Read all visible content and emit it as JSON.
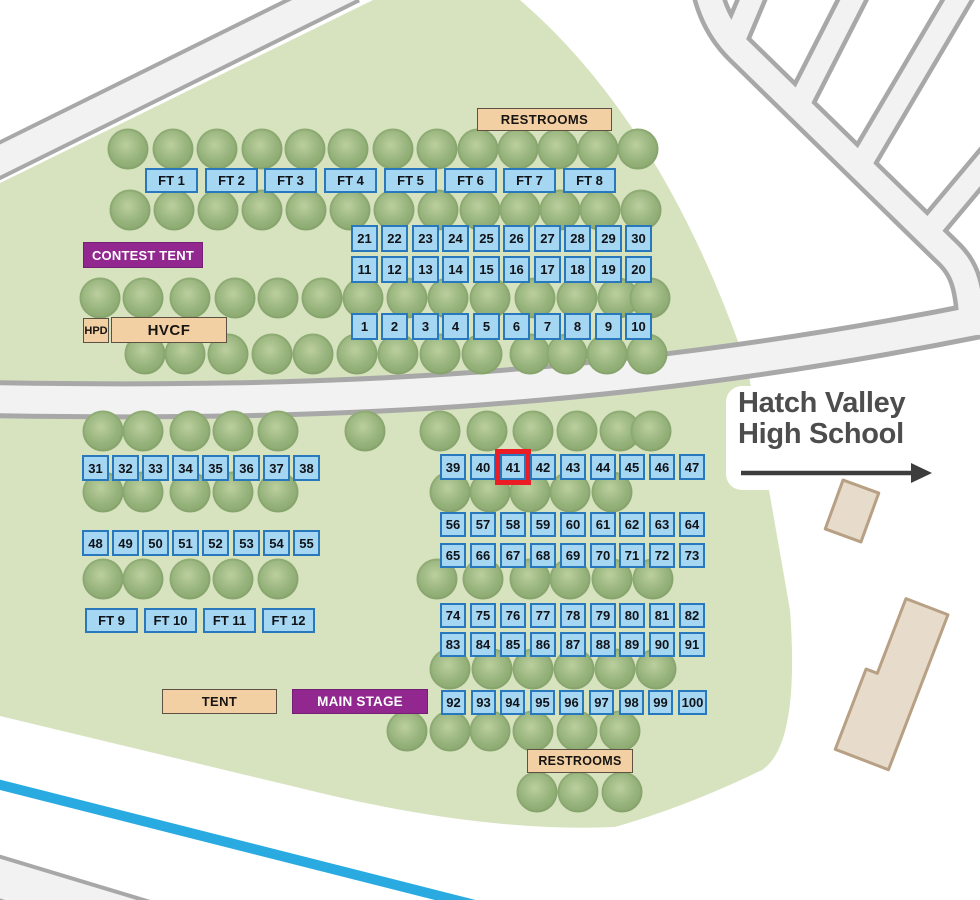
{
  "map": {
    "title_area": {
      "school": {
        "line1": "Hatch Valley",
        "line2": "High School"
      }
    },
    "labels": {
      "restrooms_top": {
        "text": "RESTROOMS"
      },
      "contest_tent": {
        "text": "CONTEST TENT"
      },
      "hpd": {
        "text": "HPD"
      },
      "hvcf": {
        "text": "HVCF"
      },
      "tent": {
        "text": "TENT"
      },
      "main_stage": {
        "text": "MAIN STAGE"
      },
      "restrooms_bottom": {
        "text": "RESTROOMS"
      }
    },
    "highlighted_booth": "41",
    "booth_rows": [
      {
        "labels": [
          "21",
          "22",
          "23",
          "24",
          "25",
          "26",
          "27",
          "28",
          "29",
          "30"
        ],
        "x": 351,
        "y": 225,
        "gap": 30.44,
        "w": 27,
        "h": 27
      },
      {
        "labels": [
          "11",
          "12",
          "13",
          "14",
          "15",
          "16",
          "17",
          "18",
          "19",
          "20"
        ],
        "x": 351,
        "y": 256,
        "gap": 30.44,
        "w": 27,
        "h": 27
      },
      {
        "labels": [
          "1",
          "2",
          "3",
          "4",
          "5",
          "6",
          "7",
          "8",
          "9",
          "10"
        ],
        "x": 351,
        "y": 313,
        "gap": 30.44,
        "w": 27,
        "h": 27
      },
      {
        "labels": [
          "31",
          "32",
          "33",
          "34",
          "35",
          "36",
          "37",
          "38"
        ],
        "x": 82,
        "y": 455,
        "gap": 30.1,
        "w": 27,
        "h": 26
      },
      {
        "labels": [
          "39",
          "40",
          "41",
          "42",
          "43",
          "44",
          "45",
          "46",
          "47"
        ],
        "x": 440,
        "y": 454,
        "gap": 29.9,
        "w": 26,
        "h": 26
      },
      {
        "labels": [
          "48",
          "49",
          "50",
          "51",
          "52",
          "53",
          "54",
          "55"
        ],
        "x": 82,
        "y": 530,
        "gap": 30.1,
        "w": 27,
        "h": 26
      },
      {
        "labels": [
          "56",
          "57",
          "58",
          "59",
          "60",
          "61",
          "62",
          "63",
          "64"
        ],
        "x": 440,
        "y": 512,
        "gap": 29.9,
        "w": 26,
        "h": 25
      },
      {
        "labels": [
          "65",
          "66",
          "67",
          "68",
          "69",
          "70",
          "71",
          "72",
          "73"
        ],
        "x": 440,
        "y": 543,
        "gap": 29.9,
        "w": 26,
        "h": 25
      },
      {
        "labels": [
          "74",
          "75",
          "76",
          "77",
          "78",
          "79",
          "80",
          "81",
          "82"
        ],
        "x": 440,
        "y": 603,
        "gap": 29.9,
        "w": 26,
        "h": 25
      },
      {
        "labels": [
          "83",
          "84",
          "85",
          "86",
          "87",
          "88",
          "89",
          "90",
          "91"
        ],
        "x": 440,
        "y": 632,
        "gap": 29.9,
        "w": 26,
        "h": 25
      },
      {
        "labels": [
          "92",
          "93",
          "94",
          "95",
          "96",
          "97",
          "98",
          "99",
          "100"
        ],
        "x": 441,
        "y": 690,
        "gap": 29.6,
        "w": 25,
        "h": 25
      }
    ],
    "food_tent_rows": [
      {
        "labels": [
          "FT 1",
          "FT 2",
          "FT 3",
          "FT 4",
          "FT 5",
          "FT 6",
          "FT 7",
          "FT 8"
        ],
        "x": 145,
        "y": 168,
        "gap": 59.7,
        "w": 53,
        "h": 25
      },
      {
        "labels": [
          "FT 9",
          "FT 10",
          "FT 11",
          "FT 12"
        ],
        "x": 85,
        "y": 608,
        "gap": 59,
        "w": 53,
        "h": 25
      }
    ],
    "trees": {
      "rows": [
        {
          "y": 149,
          "xs": [
            128,
            173,
            217,
            262,
            305,
            348,
            393,
            437,
            478,
            518,
            558,
            598,
            638
          ]
        },
        {
          "y": 210,
          "xs": [
            130,
            174,
            218,
            262,
            306,
            350,
            394,
            438,
            480,
            520,
            560,
            600,
            641
          ]
        },
        {
          "y": 298,
          "xs": [
            100,
            143,
            190,
            235,
            278,
            322,
            363,
            407,
            448,
            490,
            535,
            577,
            618,
            650
          ]
        },
        {
          "y": 354,
          "xs": [
            145,
            185,
            228,
            272,
            313,
            357,
            398,
            440,
            482,
            530,
            567,
            607,
            647
          ]
        },
        {
          "y": 431,
          "xs": [
            103,
            143,
            190,
            233,
            278,
            365,
            440,
            487,
            533,
            577,
            620,
            651
          ]
        },
        {
          "y": 492,
          "xs": [
            103,
            143,
            190,
            233,
            278,
            450,
            490,
            530,
            570,
            612
          ]
        },
        {
          "y": 579,
          "xs": [
            103,
            143,
            190,
            233,
            278,
            437,
            483,
            530,
            570,
            612,
            653
          ]
        },
        {
          "y": 669,
          "xs": [
            450,
            492,
            533,
            574,
            615,
            656
          ]
        },
        {
          "y": 731,
          "xs": [
            407,
            450,
            490,
            533,
            577,
            620
          ]
        },
        {
          "y": 792,
          "xs": [
            537,
            578,
            622
          ]
        }
      ]
    },
    "colors": {
      "field": "#D7E3BF",
      "road_fill": "#F2F2F2",
      "road_border": "#A8A8A8",
      "booth_fill": "#A5D6F2",
      "booth_border": "#2878BE",
      "highlight_red": "#EC1C24",
      "purple": "#92278F",
      "tan": "#F2D0A4",
      "building_fill": "#E7DCCB",
      "building_border": "#B7A084",
      "canal_blue": "#29ABE2",
      "text_dark": "#4D4D4D"
    }
  }
}
